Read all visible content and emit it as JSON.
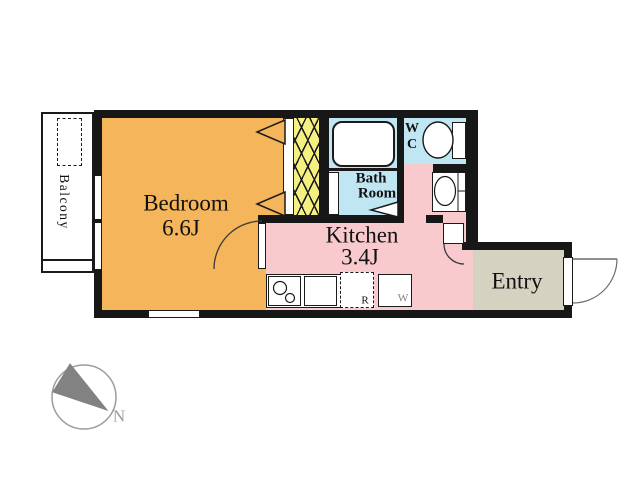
{
  "colors": {
    "bedroom": "#f5b55a",
    "kitchen": "#f9cacd",
    "water": "#c0e6f4",
    "closet": "#f6f083",
    "entry": "#d5d2c2",
    "wall": "#171717",
    "outline": "#1a1a1a",
    "door_arc": "#3a3a3a",
    "entry_arc": "#6b6b6b",
    "muted": "#8a8a8a",
    "compass_needle": "#828282",
    "compass_ring": "#9c9c9c",
    "counter_shadow": "#b2b2b2"
  },
  "rooms": {
    "balcony": {
      "label": "Balcony"
    },
    "bedroom": {
      "label": "Bedroom",
      "size": "6.6J"
    },
    "kitchen": {
      "label": "Kitchen",
      "size": "3.4J"
    },
    "bath": {
      "line1": "Bath",
      "line2": "Room"
    },
    "wc": {
      "line1": "W",
      "line2": "C"
    },
    "entry": {
      "label": "Entry"
    }
  },
  "fixtures": {
    "refrigerator_label": "R",
    "washer_label": "W"
  },
  "compass": {
    "north_label": "N"
  }
}
